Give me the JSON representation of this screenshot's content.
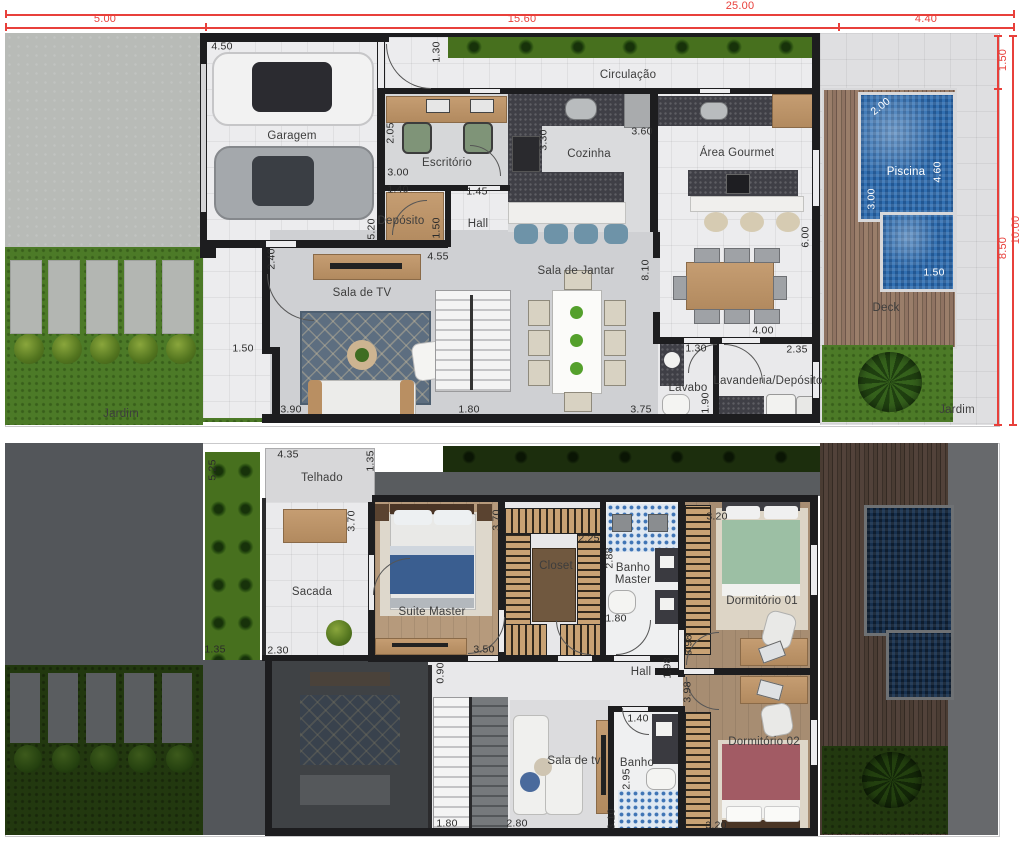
{
  "colors": {
    "dimension_red": "#e8403b",
    "wall": "#1d1d1f",
    "grass": "#4c7a27",
    "grass_dimmed": "#22380f",
    "pool_water": "#3270b2",
    "deck_wood": "#8f7362",
    "furniture_wood": "#bf9569",
    "countertop_granite": "#3f3f46",
    "floor_light": "#ececee",
    "floor_grey": "#cfd0d3",
    "dim_text": "#2b2b2b"
  },
  "site": {
    "dims": [
      {
        "t": "25.00",
        "x": 740,
        "y": 7,
        "c": "red"
      },
      {
        "t": "5.00",
        "x": 105,
        "y": 20,
        "c": "red"
      },
      {
        "t": "15.60",
        "x": 522,
        "y": 20,
        "c": "red"
      },
      {
        "t": "4.40",
        "x": 926,
        "y": 20,
        "c": "red"
      },
      {
        "t": "1.50",
        "x": 1004,
        "y": 60,
        "r": 1,
        "c": "red"
      },
      {
        "t": "8.50",
        "x": 1004,
        "y": 248,
        "r": 1,
        "c": "red"
      },
      {
        "t": "10.00",
        "x": 1017,
        "y": 230,
        "r": 1,
        "c": "red"
      }
    ]
  },
  "ground_floor": {
    "rooms": [
      {
        "t": "Garagem",
        "x": 292,
        "y": 136,
        "c": "room"
      },
      {
        "t": "Circulação",
        "x": 628,
        "y": 75,
        "c": "room"
      },
      {
        "t": "Escritório",
        "x": 447,
        "y": 163,
        "c": "room"
      },
      {
        "t": "Depósito",
        "x": 401,
        "y": 221,
        "c": "room"
      },
      {
        "t": "Hall",
        "x": 478,
        "y": 224,
        "c": "room"
      },
      {
        "t": "Sala de TV",
        "x": 362,
        "y": 293,
        "c": "room"
      },
      {
        "t": "Cozinha",
        "x": 589,
        "y": 154,
        "c": "room"
      },
      {
        "t": "Área Gourmet",
        "x": 737,
        "y": 153,
        "c": "room"
      },
      {
        "t": "Sala de Jantar",
        "x": 576,
        "y": 271,
        "c": "room"
      },
      {
        "t": "Lavabo",
        "x": 688,
        "y": 388,
        "c": "room"
      },
      {
        "t": "Lavanderia/Depósito",
        "x": 768,
        "y": 381,
        "c": "room"
      },
      {
        "t": "Deck",
        "x": 886,
        "y": 308,
        "c": "room"
      },
      {
        "t": "Jardim",
        "x": 121,
        "y": 414,
        "c": "room"
      },
      {
        "t": "Jardim",
        "x": 957,
        "y": 410,
        "c": "room"
      }
    ],
    "dims": [
      {
        "t": "4.50",
        "x": 222,
        "y": 47
      },
      {
        "t": "1.30",
        "x": 437,
        "y": 52,
        "r": 1
      },
      {
        "t": "2.05",
        "x": 391,
        "y": 133,
        "r": 1
      },
      {
        "t": "3.00",
        "x": 398,
        "y": 173
      },
      {
        "t": "1.40",
        "x": 398,
        "y": 190
      },
      {
        "t": "1.45",
        "x": 477,
        "y": 192
      },
      {
        "t": "5.20",
        "x": 372,
        "y": 229,
        "r": 1
      },
      {
        "t": "1.50",
        "x": 437,
        "y": 228,
        "r": 1
      },
      {
        "t": "2.40",
        "x": 272,
        "y": 259,
        "r": 1
      },
      {
        "t": "4.55",
        "x": 438,
        "y": 257
      },
      {
        "t": "3.30",
        "x": 544,
        "y": 140,
        "r": 1
      },
      {
        "t": "3.60",
        "x": 642,
        "y": 132
      },
      {
        "t": "8.10",
        "x": 646,
        "y": 270,
        "r": 1
      },
      {
        "t": "6.00",
        "x": 806,
        "y": 237,
        "r": 1
      },
      {
        "t": "4.00",
        "x": 763,
        "y": 331
      },
      {
        "t": "1.30",
        "x": 696,
        "y": 349
      },
      {
        "t": "2.35",
        "x": 797,
        "y": 350
      },
      {
        "t": "1.90",
        "x": 706,
        "y": 403,
        "r": 1
      },
      {
        "t": "1.50",
        "x": 243,
        "y": 349
      },
      {
        "t": "3.90",
        "x": 291,
        "y": 410
      },
      {
        "t": "1.80",
        "x": 469,
        "y": 410
      },
      {
        "t": "3.75",
        "x": 641,
        "y": 410
      }
    ],
    "pool_labels": [
      {
        "t": "Piscina",
        "x": 906,
        "y": 172,
        "c": "white room"
      },
      {
        "t": "2.00",
        "x": 881,
        "y": 107,
        "a": -38,
        "c": "white"
      },
      {
        "t": "4.60",
        "x": 938,
        "y": 172,
        "r": 1,
        "c": "white"
      },
      {
        "t": "3.00",
        "x": 872,
        "y": 199,
        "r": 1,
        "c": "white"
      },
      {
        "t": "1.50",
        "x": 934,
        "y": 273,
        "c": "white"
      }
    ]
  },
  "upper_floor": {
    "rooms": [
      {
        "t": "Telhado",
        "x": 322,
        "y": 478,
        "c": "room"
      },
      {
        "t": "Sacada",
        "x": 312,
        "y": 592,
        "c": "room"
      },
      {
        "t": "Suite Master",
        "x": 432,
        "y": 612,
        "c": "room"
      },
      {
        "t": "Closet",
        "x": 556,
        "y": 566,
        "c": "room"
      },
      {
        "t": "Banho Master",
        "x": 633,
        "y": 574,
        "c": "room",
        "w": 52
      },
      {
        "t": "Dormitório 01",
        "x": 762,
        "y": 601,
        "c": "room"
      },
      {
        "t": "Hall",
        "x": 641,
        "y": 672,
        "c": "room"
      },
      {
        "t": "Sala de tv",
        "x": 574,
        "y": 761,
        "c": "room"
      },
      {
        "t": "Banho",
        "x": 637,
        "y": 763,
        "c": "room"
      },
      {
        "t": "Dormitório 02",
        "x": 764,
        "y": 742,
        "c": "room"
      }
    ],
    "dims": [
      {
        "t": "5.25",
        "x": 213,
        "y": 470,
        "r": 1
      },
      {
        "t": "4.35",
        "x": 288,
        "y": 455
      },
      {
        "t": "1.35",
        "x": 371,
        "y": 461,
        "r": 1
      },
      {
        "t": "3.70",
        "x": 352,
        "y": 521,
        "r": 1
      },
      {
        "t": "3.70",
        "x": 497,
        "y": 520,
        "r": 1
      },
      {
        "t": "2.25",
        "x": 589,
        "y": 539
      },
      {
        "t": "2.88",
        "x": 610,
        "y": 558,
        "r": 1
      },
      {
        "t": "3.20",
        "x": 717,
        "y": 517
      },
      {
        "t": "1.80",
        "x": 616,
        "y": 619
      },
      {
        "t": "1.35",
        "x": 215,
        "y": 650
      },
      {
        "t": "2.30",
        "x": 278,
        "y": 651
      },
      {
        "t": "3.50",
        "x": 484,
        "y": 650
      },
      {
        "t": "3.98",
        "x": 689,
        "y": 645,
        "r": 1
      },
      {
        "t": "1.98",
        "x": 668,
        "y": 668,
        "r": 1
      },
      {
        "t": "0.90",
        "x": 441,
        "y": 673,
        "r": 1
      },
      {
        "t": "3.98",
        "x": 688,
        "y": 692,
        "r": 1
      },
      {
        "t": "1.40",
        "x": 638,
        "y": 719
      },
      {
        "t": "2.95",
        "x": 627,
        "y": 779,
        "r": 1
      },
      {
        "t": "3.10",
        "x": 612,
        "y": 819,
        "r": 1
      },
      {
        "t": "1.80",
        "x": 447,
        "y": 824
      },
      {
        "t": "2.80",
        "x": 517,
        "y": 824
      },
      {
        "t": "3.20",
        "x": 716,
        "y": 826
      }
    ]
  }
}
